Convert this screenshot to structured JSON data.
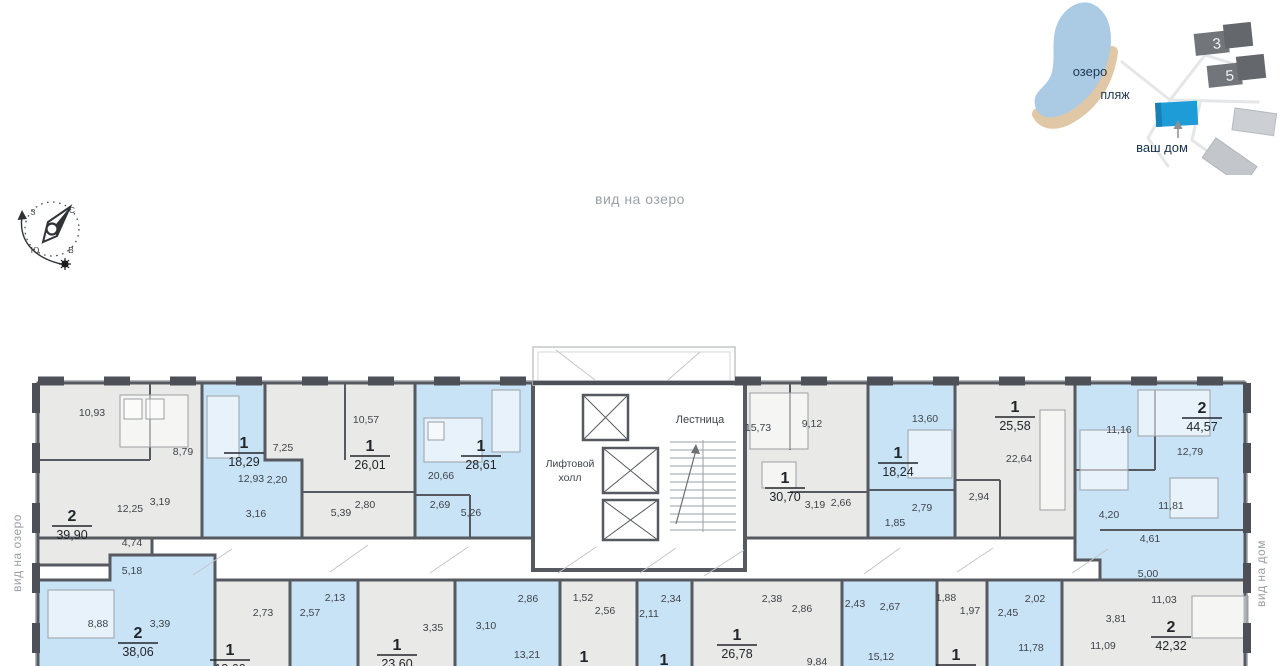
{
  "header": {
    "view_top": "вид на озеро"
  },
  "side_labels": {
    "left": "вид на озеро",
    "right": "вид на дом"
  },
  "sitemap": {
    "lake": "озеро",
    "beach": "пляж",
    "your_home": "ваш дом",
    "building_3": "3",
    "building_5": "5"
  },
  "core": {
    "elevator_line1": "Лифтовой",
    "elevator_line2": "холл",
    "stairs": "Лестница"
  },
  "colors": {
    "flat_blue": "#c9e3f6",
    "flat_gray": "#e9e9e7",
    "wall": "#565a60",
    "your_home_blue": "#1e9cd7",
    "lake_blue": "#abcbe4",
    "beach_tan": "#e0c7a5"
  },
  "apartments": [
    {
      "num": "2",
      "area": "39,90",
      "rooms": [
        "10,93",
        "8,79",
        "12,25",
        "3,19",
        "4,74"
      ]
    },
    {
      "num": "1",
      "area": "18,29",
      "rooms": [
        "12,93",
        "2,20",
        "3,16"
      ]
    },
    {
      "num": "1",
      "area": "26,01",
      "rooms": [
        "7,25",
        "10,57",
        "2,80",
        "5,39"
      ]
    },
    {
      "num": "1",
      "area": "28,61",
      "rooms": [
        "20,66",
        "2,69",
        "5,26"
      ]
    },
    {
      "num": "1",
      "area": "30,70",
      "rooms": [
        "15,73",
        "9,12",
        "3,19",
        "2,66"
      ]
    },
    {
      "num": "1",
      "area": "18,24",
      "rooms": [
        "13,60",
        "2,79",
        "1,85"
      ]
    },
    {
      "num": "1",
      "area": "25,58",
      "rooms": [
        "22,64",
        "2,94"
      ]
    },
    {
      "num": "2",
      "area": "44,57",
      "rooms": [
        "11,16",
        "12,79",
        "11,81",
        "4,20",
        "4,61",
        "5,00"
      ]
    },
    {
      "num": "2",
      "area": "38,06",
      "rooms": [
        "5,18",
        "8,88",
        "3,39"
      ]
    },
    {
      "num": "1",
      "area": "18,60",
      "rooms": [
        "2,73"
      ]
    },
    {
      "rooms": [
        "2,13",
        "2,57"
      ]
    },
    {
      "num": "1",
      "area": "23,60",
      "rooms": [
        "3,35"
      ]
    },
    {
      "rooms": [
        "2,86",
        "3,10",
        "13,21"
      ]
    },
    {
      "num": "1",
      "rooms": [
        "1,52",
        "2,56"
      ]
    },
    {
      "num": "1",
      "rooms": [
        "2,34",
        "2,11"
      ]
    },
    {
      "num": "1",
      "area": "26,78",
      "rooms": [
        "2,38",
        "2,86",
        "9,84"
      ]
    },
    {
      "rooms": [
        "2,43",
        "2,67",
        "15,12"
      ]
    },
    {
      "num": "1",
      "rooms": [
        "1,88",
        "1,97"
      ]
    },
    {
      "rooms": [
        "2,02",
        "2,45",
        "11,78"
      ]
    },
    {
      "num": "2",
      "area": "42,32",
      "rooms": [
        "11,03",
        "3,81",
        "11,09"
      ]
    }
  ]
}
